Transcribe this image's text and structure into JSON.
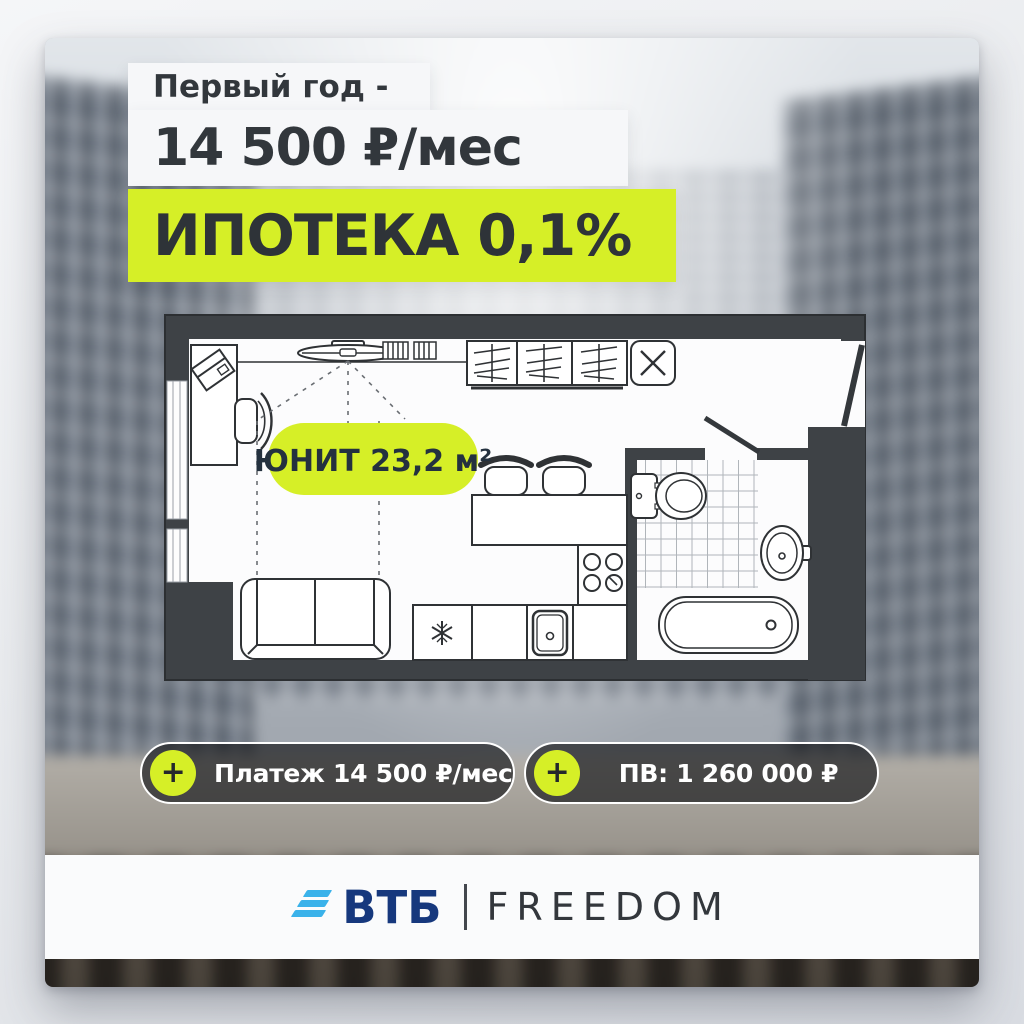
{
  "promo": {
    "line1": "Первый год -",
    "line2": "14 500 ₽/мес",
    "line3": "ИПОТЕКА 0,1%"
  },
  "floor_plan": {
    "unit_label": "ЮНИТ 23,2 м²"
  },
  "badges": {
    "payment": {
      "icon": "+",
      "label": "Платеж 14 500 ₽/мес"
    },
    "down_payment": {
      "icon": "+",
      "label": "ПВ: 1 260 000 ₽"
    }
  },
  "footer": {
    "bank": "ВТБ",
    "brand": "FREEDOM"
  },
  "colors": {
    "accent_lime": "#d6ef27",
    "dark_text": "#2e3338",
    "plan_wall": "#3e4246",
    "vtb_blue": "#16387d",
    "vtb_stripe": "#3ab2ea",
    "badge_background": "rgba(22,24,27,0.68)"
  }
}
